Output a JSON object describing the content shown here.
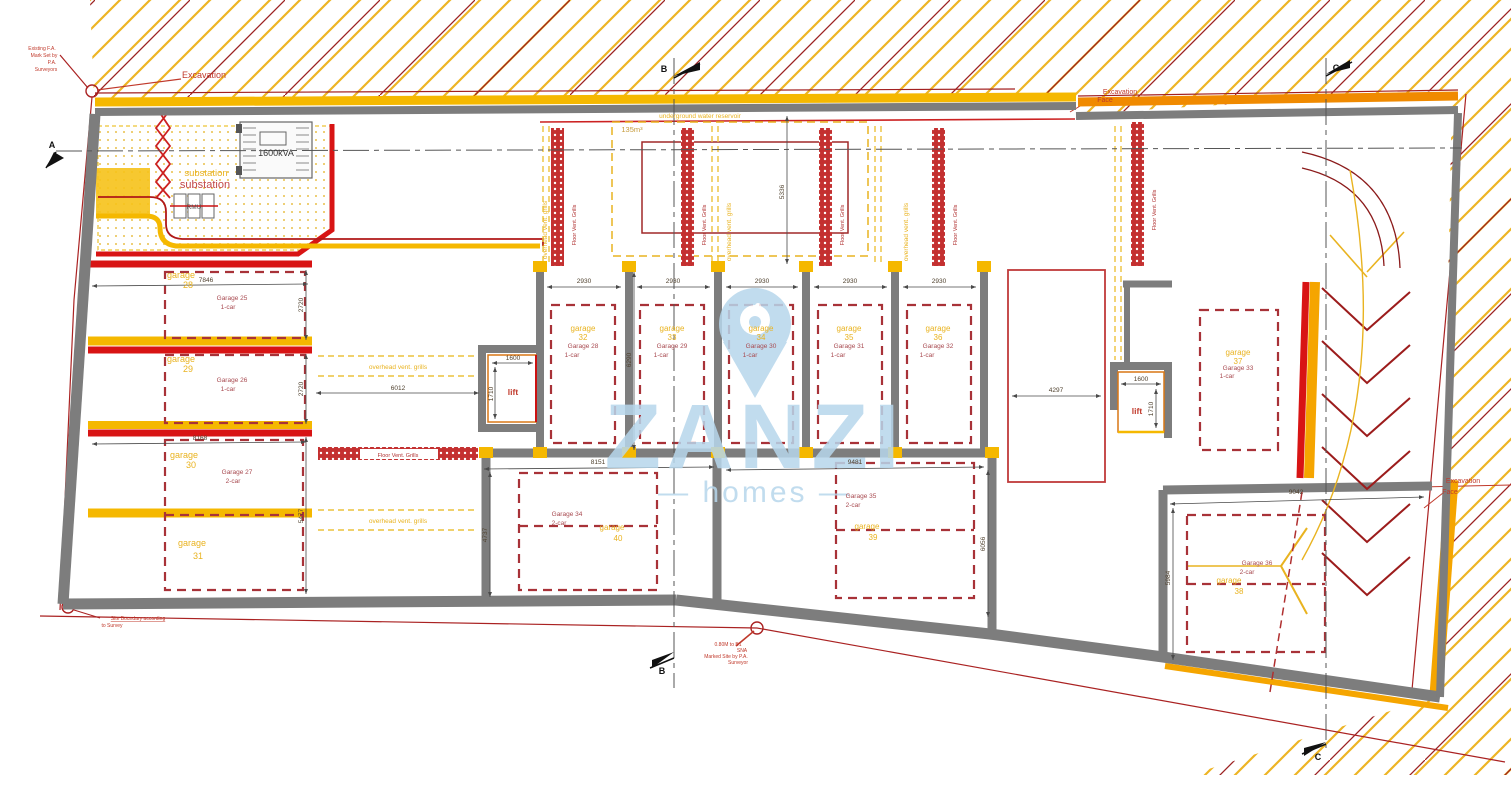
{
  "watermark": {
    "brand": "ZANZI",
    "tagline": "— homes —"
  },
  "labels": {
    "excavation": "Excavation",
    "excavation_face": [
      "Excavation",
      "Face"
    ],
    "substation": "substation",
    "kva": "1600kVA",
    "rmu": "RMU",
    "reservoir_caption": "underground water reservoir",
    "reservoir_volume": "135m³",
    "floor_vent": "Floor Vent. Grills",
    "overhead_vent": "overhead vent. grills",
    "lift": "lift",
    "section_a": "A",
    "section_b": "B",
    "section_c": "C",
    "site_boundary": [
      "Site Boundary according",
      "to Survey"
    ],
    "survey_mark": [
      "Existing F.A.",
      "Mark Set by",
      "P.A.",
      "Surveyors"
    ],
    "datum_note": [
      "0.80M to B1",
      "SNA",
      "Marked Site by P.A.",
      "Surveyor"
    ]
  },
  "garages": [
    {
      "tag": "garage",
      "num": "28",
      "name": "Garage 25",
      "type": "1-car"
    },
    {
      "tag": "garage",
      "num": "29",
      "name": "Garage 26",
      "type": "1-car"
    },
    {
      "tag": "garage",
      "num": "30",
      "name": "Garage 27",
      "type": "2-car"
    },
    {
      "tag": "garage",
      "num": "31",
      "name": "",
      "type": ""
    },
    {
      "tag": "garage",
      "num": "32",
      "name": "Garage 28",
      "type": "1-car"
    },
    {
      "tag": "garage",
      "num": "33",
      "name": "Garage 29",
      "type": "1-car"
    },
    {
      "tag": "garage",
      "num": "34",
      "name": "Garage 30",
      "type": "1-car"
    },
    {
      "tag": "garage",
      "num": "35",
      "name": "Garage 31",
      "type": "1-car"
    },
    {
      "tag": "garage",
      "num": "36",
      "name": "Garage 32",
      "type": "1-car"
    },
    {
      "tag": "garage",
      "num": "37",
      "name": "Garage 33",
      "type": "1-car"
    },
    {
      "tag": "garage",
      "num": "40",
      "name": "Garage 34",
      "type": "2-car"
    },
    {
      "tag": "garage",
      "num": "39",
      "name": "Garage 35",
      "type": "2-car"
    },
    {
      "tag": "garage",
      "num": "38",
      "name": "Garage 36",
      "type": "2-car"
    }
  ],
  "dims": {
    "d7846": "7846",
    "d2720a": "2720",
    "d2720b": "2720",
    "d8168": "8168",
    "d5477": "5477",
    "d6012": "6012",
    "d2930a": "2930",
    "d2930b": "2930",
    "d2930c": "2930",
    "d2930d": "2930",
    "d2930e": "2930",
    "d6290": "6290",
    "d5336": "5336",
    "d1600a": "1600",
    "d1710a": "1710",
    "d1600b": "1600",
    "d1710b": "1710",
    "d8151": "8151",
    "d4737": "4737",
    "d9481": "9481",
    "d6056": "6056",
    "d4297": "4297",
    "d9042": "9042",
    "d5984": "5984"
  },
  "colors": {
    "band_yellow": "#f5b800",
    "band_orange": "#f08a00",
    "wall_gray": "#7d7d7d",
    "bright_red": "#d81414",
    "dark_red": "#9c1c1c",
    "garage_dash_red": "#a83238",
    "label_yellow": "#e9b320",
    "label_red": "#a84a50",
    "watermark_blue": "#b7d7ec"
  }
}
